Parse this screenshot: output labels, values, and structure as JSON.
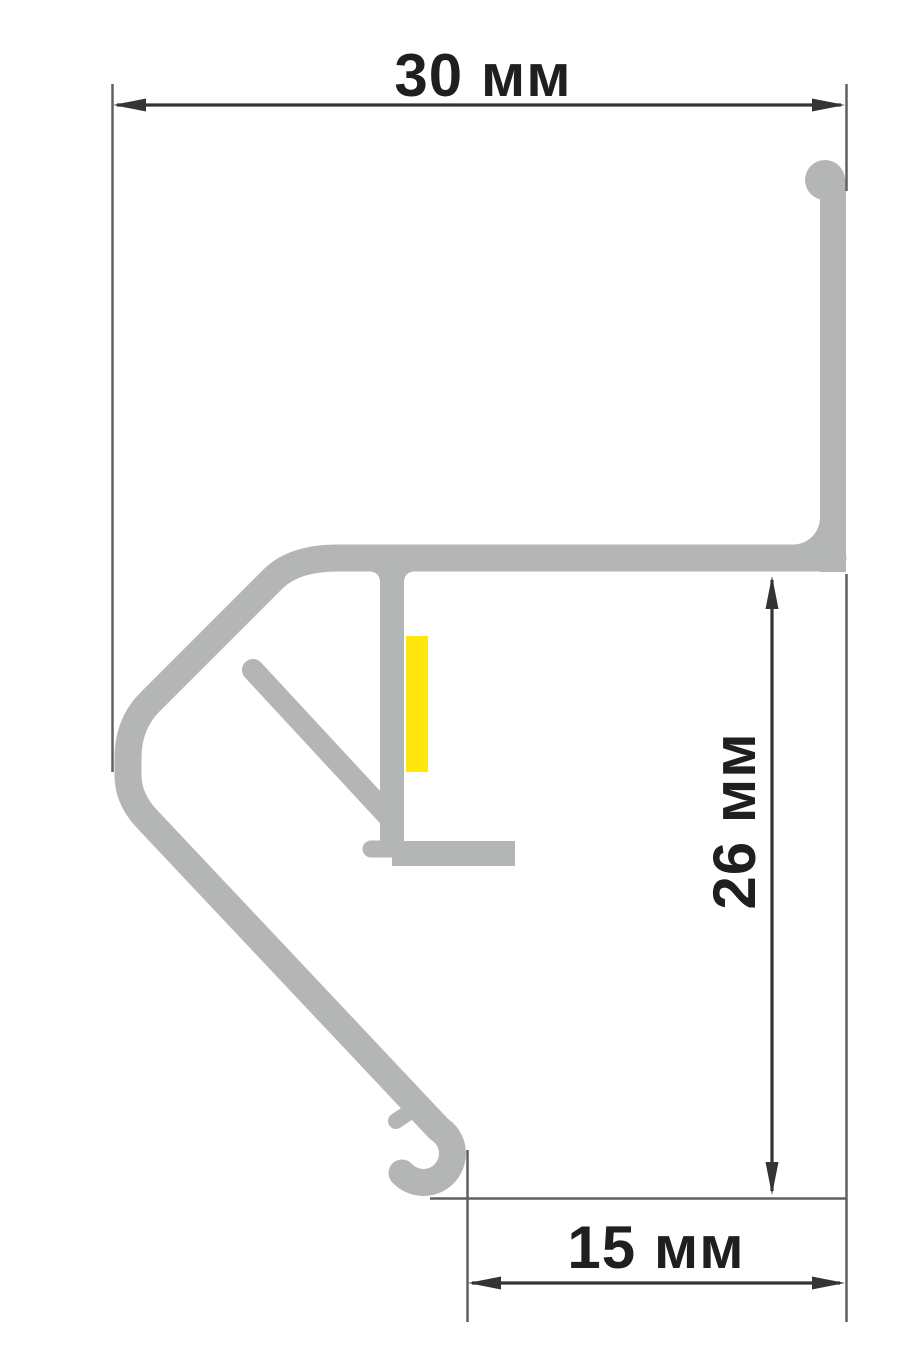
{
  "drawing": {
    "kind": "profile-cross-section-dimension-drawing",
    "labels": {
      "dim_width_top": "30 мм",
      "dim_height_right": "26 мм",
      "dim_width_bottom": "15 мм"
    },
    "values_mm": {
      "width_top": 30,
      "height_right": 26,
      "width_bottom": 15
    },
    "parts": {
      "profile_body": "aluminium-profile-outline",
      "led_strip": "led-strip-marker"
    }
  },
  "colors": {
    "background": "#ffffff",
    "profile": "#b4b5b5",
    "led_strip": "#ffe70d",
    "dimension_line": "#343434",
    "extension_line": "#606060",
    "label_text": "#1f1f1f"
  }
}
